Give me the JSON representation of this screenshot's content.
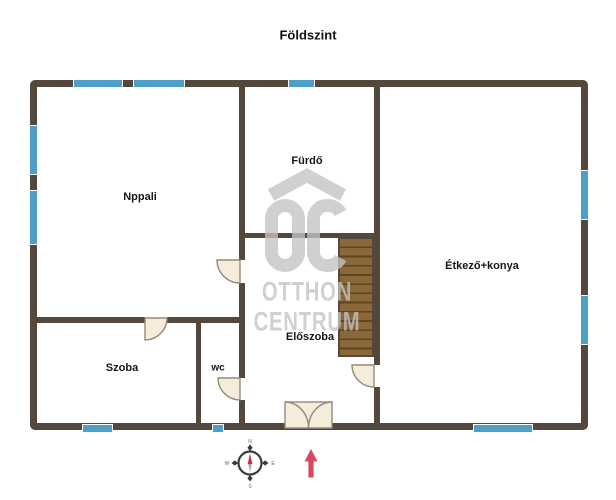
{
  "title": "Földszint",
  "rooms": [
    {
      "name": "Nppali"
    },
    {
      "name": "Fürdő"
    },
    {
      "name": "Étkező+konya"
    },
    {
      "name": "Szoba"
    },
    {
      "name": "wc"
    },
    {
      "name": "Előszoba"
    }
  ],
  "watermark": {
    "monogram": "OC",
    "line1": "OTTHON",
    "line2": "CENTRUM"
  },
  "compass": {
    "n": "N",
    "e": "E",
    "s": "S",
    "w": "W"
  },
  "colors": {
    "wall": "#54473c",
    "win": "#4e9fc8",
    "door": "#f5ecdc",
    "door_stroke": "#97897a",
    "stairs": "#8b683a",
    "stairs_line": "#5f4526",
    "watermark": "#c4c4c4",
    "arrow": "#d8495e",
    "needle": "#c9303c"
  }
}
